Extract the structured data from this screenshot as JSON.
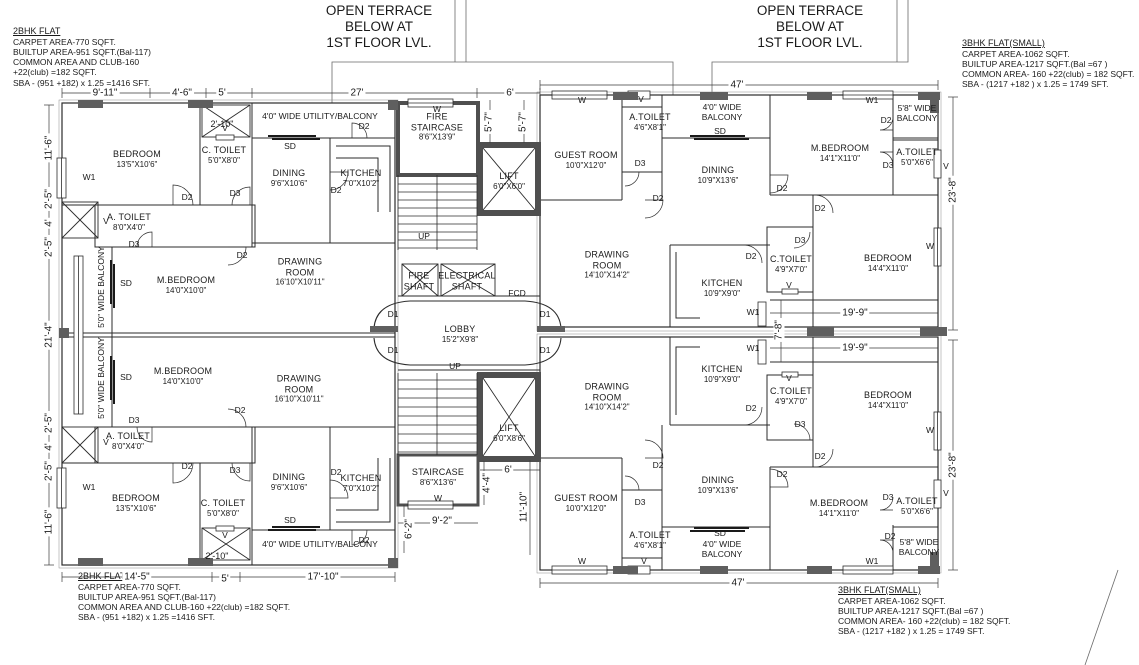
{
  "terrace": {
    "l1": "OPEN TERRACE",
    "l2": "BELOW AT",
    "l3": "1ST FLOOR LVL."
  },
  "flat2bhk": {
    "title": "2BHK FLAT",
    "line1": "CARPET AREA-770 SQFT.",
    "line2": "BUILTUP AREA-951 SQFT.(Bal-117)",
    "line3": "COMMON AREA AND CLUB-160",
    "line4": "+22(club) =182 SQFT.",
    "line34": "COMMON AREA AND CLUB-160 +22(club) =182 SQFT.",
    "line5": "SBA - (951 +182) x 1.25 =1416 SFT."
  },
  "flat3bhk": {
    "title": "3BHK FLAT(SMALL)",
    "line1": "CARPET AREA-1062 SQFT.",
    "line2": "BUILTUP AREA-1217 SQFT.(Bal =67 )",
    "line3": "COMMON AREA- 160 +22(club)  = 182 SQFT.",
    "line4": "SBA - (1217 +182 ) x 1.25 = 1749 SFT."
  },
  "rooms": {
    "bedroom1": {
      "name": "BEDROOM",
      "size": "13'5\"X10'6\""
    },
    "ctoilet1": {
      "name": "C. TOILET",
      "size": "5'0\"X8'0\""
    },
    "atoilet1": {
      "name": "A. TOILET",
      "size": "8'0\"X4'0\""
    },
    "mbedroom1": {
      "name": "M.BEDROOM",
      "size": "14'0\"X10'0\""
    },
    "dining1": {
      "name": "DINING",
      "size": "9'6\"X10'6\""
    },
    "kitchen1": {
      "name": "KITCHEN",
      "size": "7'0\"X10'2\""
    },
    "drawing1": {
      "name": "DRAWING\nROOM",
      "size": "16'10\"X10'11\""
    },
    "firestair": {
      "name": "FIRE\nSTAIRCASE",
      "size": "8'6\"X13'9\""
    },
    "lift1": {
      "name": "LIFT",
      "size": "6'0\"X6'0\""
    },
    "lobby": {
      "name": "LOBBY",
      "size": "15'2\"X9'8\""
    },
    "lift2": {
      "name": "LIFT",
      "size": "6'0\"X8'6\""
    },
    "stair2": {
      "name": "STAIRCASE",
      "size": "8'6\"X13'6\""
    },
    "fireshaft": {
      "name": "FIRE\nSHAFT",
      "size": ""
    },
    "elecshaft": {
      "name": "ELECTRICAL\nSHAFT",
      "size": ""
    },
    "guest": {
      "name": "GUEST ROOM",
      "size": "10'0\"X12'0\""
    },
    "atoilet2": {
      "name": "A.TOILET",
      "size": "4'6\"X8'1\""
    },
    "dining2": {
      "name": "DINING",
      "size": "10'9\"X13'6\""
    },
    "drawing2": {
      "name": "DRAWING\nROOM",
      "size": "14'10\"X14'2\""
    },
    "kitchen2": {
      "name": "KITCHEN",
      "size": "10'9\"X9'0\""
    },
    "ctoilet2": {
      "name": "C.TOILET",
      "size": "4'9\"X7'0\""
    },
    "mbedroom2": {
      "name": "M.BEDROOM",
      "size": "14'1\"X11'0\""
    },
    "atoilet3": {
      "name": "A.TOILET",
      "size": "5'0\"X6'6\""
    },
    "bedroom2": {
      "name": "BEDROOM",
      "size": "14'4\"X11'0\""
    }
  },
  "balconies": {
    "utility": "4'0\" WIDE UTILITY/BALCONY",
    "wide50": "5'0\" WIDE BALCONY",
    "wide40": "4'0\" WIDE\nBALCONY",
    "wide58": "5'8\" WIDE\nBALCONY"
  },
  "tags": {
    "d1": "D1",
    "d2": "D2",
    "d3": "D3",
    "sd": "SD",
    "w": "W",
    "w1": "W1",
    "v": "V",
    "up": "UP",
    "fcd": "FCD"
  },
  "dims": {
    "w9_11": "9'-11\"",
    "w4_6": "4'-6\"",
    "w5": "5'",
    "w27": "27'",
    "w6": "6'",
    "w47": "47'",
    "h11_6": "11'-6\"",
    "h2_5": "2'-5\"",
    "h4": "4'",
    "h21_4": "21'-4\"",
    "h23_8": "23'-8\"",
    "w19_9": "19'-9\"",
    "h7_8": "7'-8\"",
    "h5_7": "5'-7\"",
    "w14_5": "14'-5\"",
    "w17_10": "17'-10\"",
    "w9_2": "9'-2\"",
    "h6_2": "6'-2\"",
    "h4_4": "4'-4\"",
    "h11_10": "11'-10\"",
    "w2_10": "2'-10\""
  },
  "colors": {
    "wall": "#2b2b2b",
    "column": "#5f5f5f",
    "background": "#ffffff"
  }
}
